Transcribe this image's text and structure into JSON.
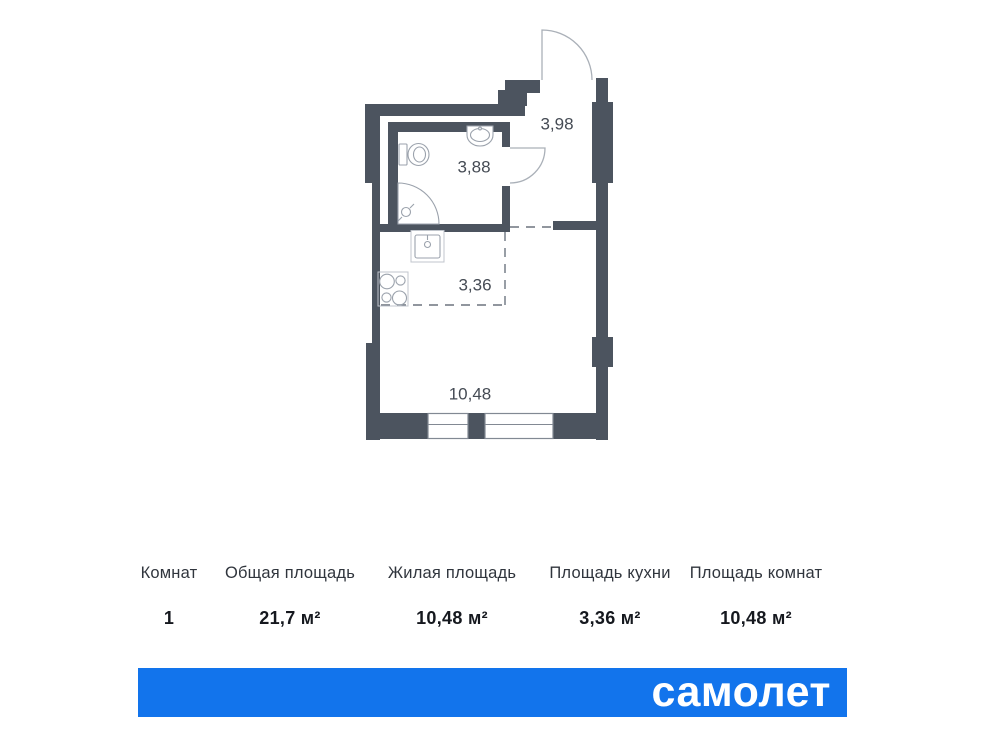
{
  "floor_plan": {
    "rooms": [
      {
        "name": "hallway",
        "area": "3,98"
      },
      {
        "name": "bathroom",
        "area": "3,88"
      },
      {
        "name": "kitchen-zone",
        "area": "3,36"
      },
      {
        "name": "living-room",
        "area": "10,48"
      }
    ],
    "icons": [
      "entry-door-arc",
      "bathroom-door-arc",
      "toilet-icon",
      "washbasin-icon",
      "shower-icon",
      "kitchen-sink-icon",
      "stove-icon",
      "window-symbol"
    ],
    "colors": {
      "wall": "#4c545f",
      "fixture_line": "#9ba2ac",
      "dashed_zone": "#6d747f",
      "label_text": "#454b54"
    }
  },
  "summary": {
    "columns": [
      {
        "label": "Комнат",
        "value": "1"
      },
      {
        "label": "Общая площадь",
        "value": "21,7 м²"
      },
      {
        "label": "Жилая площадь",
        "value": "10,48 м²"
      },
      {
        "label": "Площадь кухни",
        "value": "3,36 м²"
      },
      {
        "label": "Площадь комнат",
        "value": "10,48 м²"
      }
    ]
  },
  "footer": {
    "brand": "самолет",
    "banner_color": "#1274ec"
  }
}
